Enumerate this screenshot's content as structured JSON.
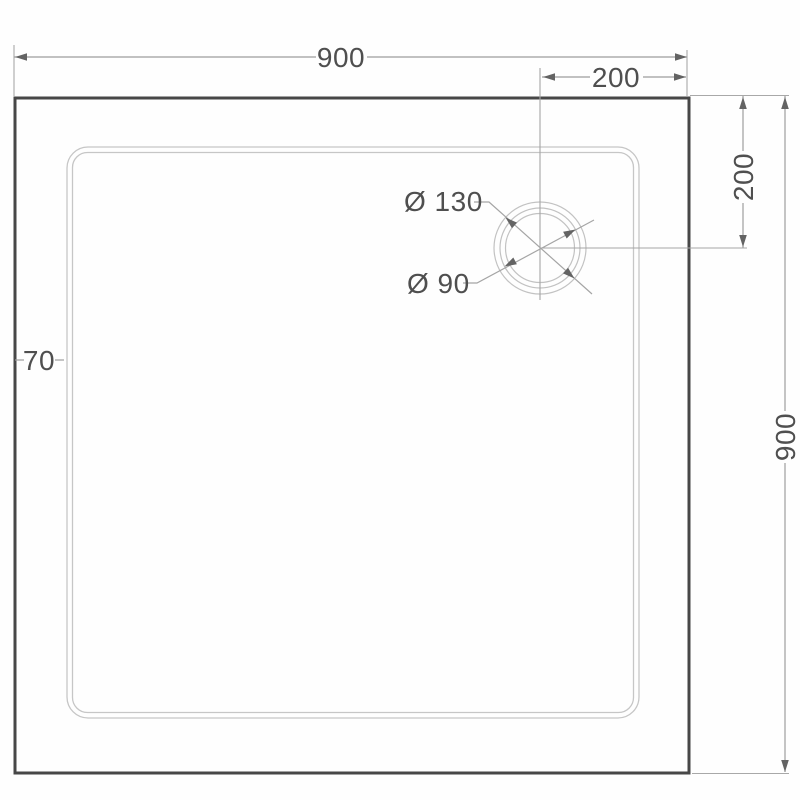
{
  "diagram": {
    "type": "technical dimension drawing",
    "subject": "Square shower tray, top view, with waste/drain position",
    "labels": {
      "overall_width": "900",
      "overall_height": "900",
      "drain_offset_from_right": "200",
      "drain_offset_from_top": "200",
      "rim_width": "70",
      "drain_outer_diameter": "Ø 130",
      "drain_inner_diameter": "Ø 90"
    },
    "colors": {
      "background": "#fefefe",
      "outer_edge": "#474747",
      "rim_line": "#c6c6c6",
      "drain_line": "#c2c2c2",
      "dimension_line": "#9d9d9d",
      "text": "#4f4f4f"
    }
  }
}
